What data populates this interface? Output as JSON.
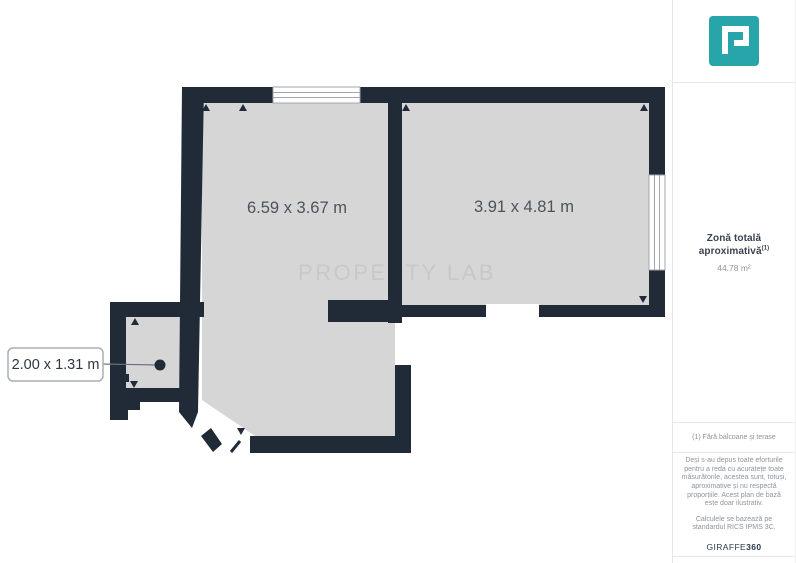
{
  "plan": {
    "watermark": "PROPERTY LAB",
    "rooms": [
      {
        "id": "room-1",
        "dims": "6.59 x 3.67 m"
      },
      {
        "id": "room-2",
        "dims": "3.91 x 4.81 m"
      },
      {
        "id": "room-3",
        "dims": "2.00 x 1.31 m"
      }
    ]
  },
  "sidebar": {
    "logo": "property-lab-logo",
    "area_title": "Zonă totală aproximativă",
    "area_title_sup": "(1)",
    "area_value": "44.78 m²",
    "footnote": "(1) Fără balcoane și terase",
    "disclaimer": "Deși s-au depus toate eforturile pentru a reda cu acuratețe toate măsurătorile, acestea sunt, totuși, aproximative și nu respectă proporțiile. Acest plan de bază este doar ilustrativ.",
    "standard": "Calculele se bazează pe standardul RICS IPMS 3C.",
    "brand": "GIRAFFE",
    "brand_suffix": "360"
  },
  "colors": {
    "wall": "#212B38",
    "floor": "#D6D6D7",
    "accent": "#28A5AB",
    "watermark": "#C8C8C8"
  }
}
